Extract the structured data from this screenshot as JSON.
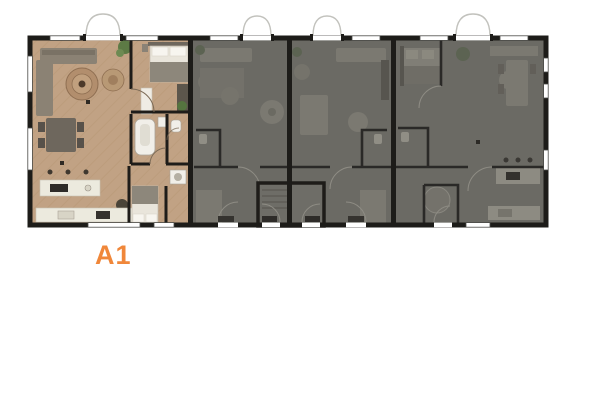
{
  "plan": {
    "selected_unit": {
      "label": "A1",
      "label_color": "#f0873a",
      "floor_color": "#c1a284",
      "state": "highlighted"
    },
    "other_units": {
      "count": 3,
      "state": "dimmed",
      "overlay_color": "#6b6a64"
    },
    "wall_color": "#1d1c19",
    "background_color": "#ffffff"
  }
}
